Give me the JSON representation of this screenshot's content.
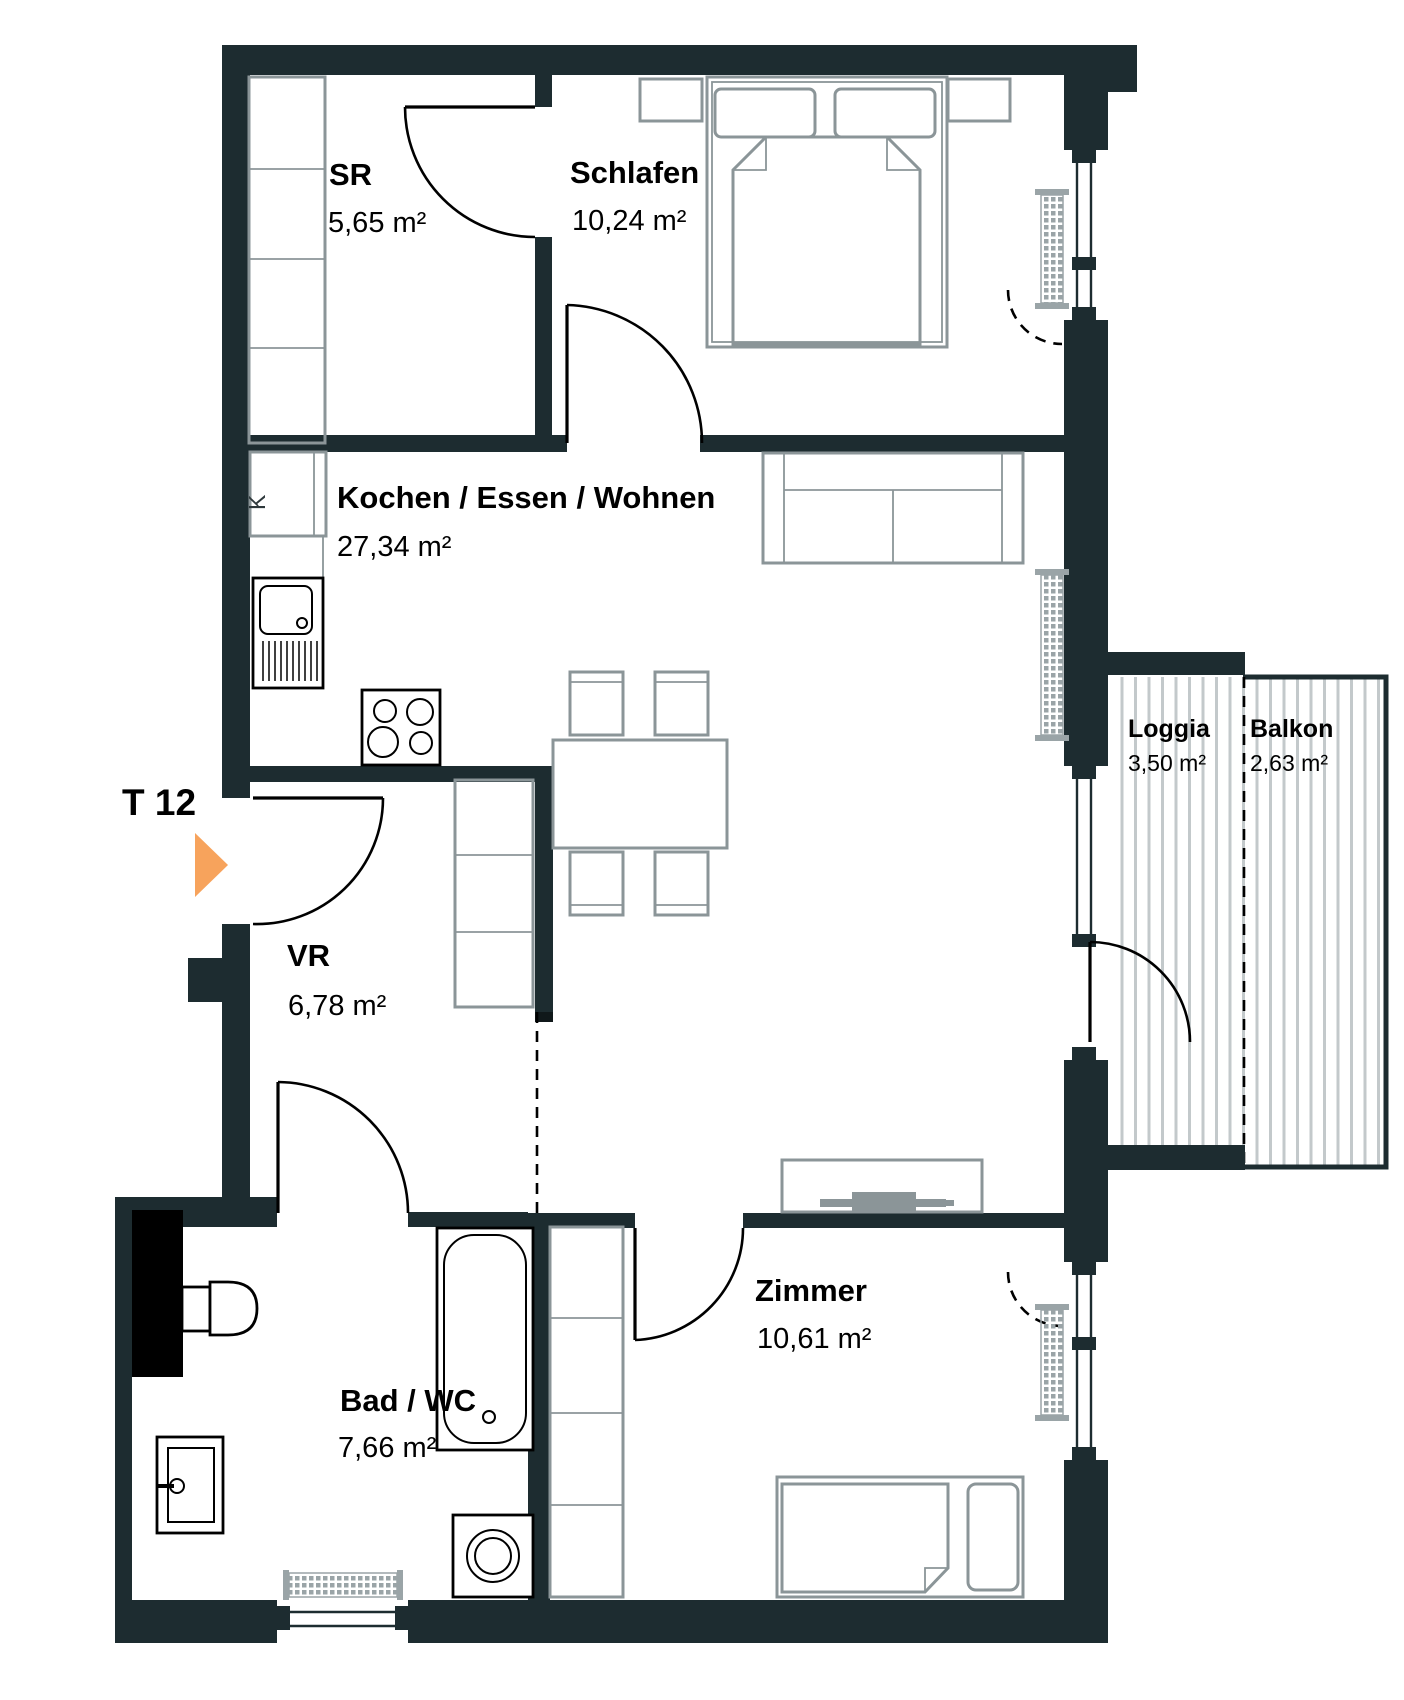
{
  "unit": {
    "label": "T 12"
  },
  "rooms": {
    "sr": {
      "name": "SR",
      "area": "5,65 m²"
    },
    "schlafen": {
      "name": "Schlafen",
      "area": "10,24 m²"
    },
    "kochen": {
      "name": "Kochen / Essen / Wohnen",
      "area": "27,34 m²"
    },
    "vr": {
      "name": "VR",
      "area": "6,78 m²"
    },
    "bad": {
      "name": "Bad / WC",
      "area": "7,66 m²"
    },
    "zimmer": {
      "name": "Zimmer",
      "area": "10,61 m²"
    },
    "loggia": {
      "name": "Loggia",
      "area": "3,50 m²"
    },
    "balkon": {
      "name": "Balkon",
      "area": "2,63 m²"
    }
  },
  "kitchen": {
    "fridge_label": "K"
  },
  "colors": {
    "wall": "#1D2C30",
    "shaft": "#000000",
    "entrance_arrow": "#F7A35C",
    "furniture": "#8B9598",
    "fixtures": "#000000",
    "radiator": "#9AA4A7",
    "deck_stripe": "#C3C9CB",
    "background": "#FFFFFF"
  }
}
